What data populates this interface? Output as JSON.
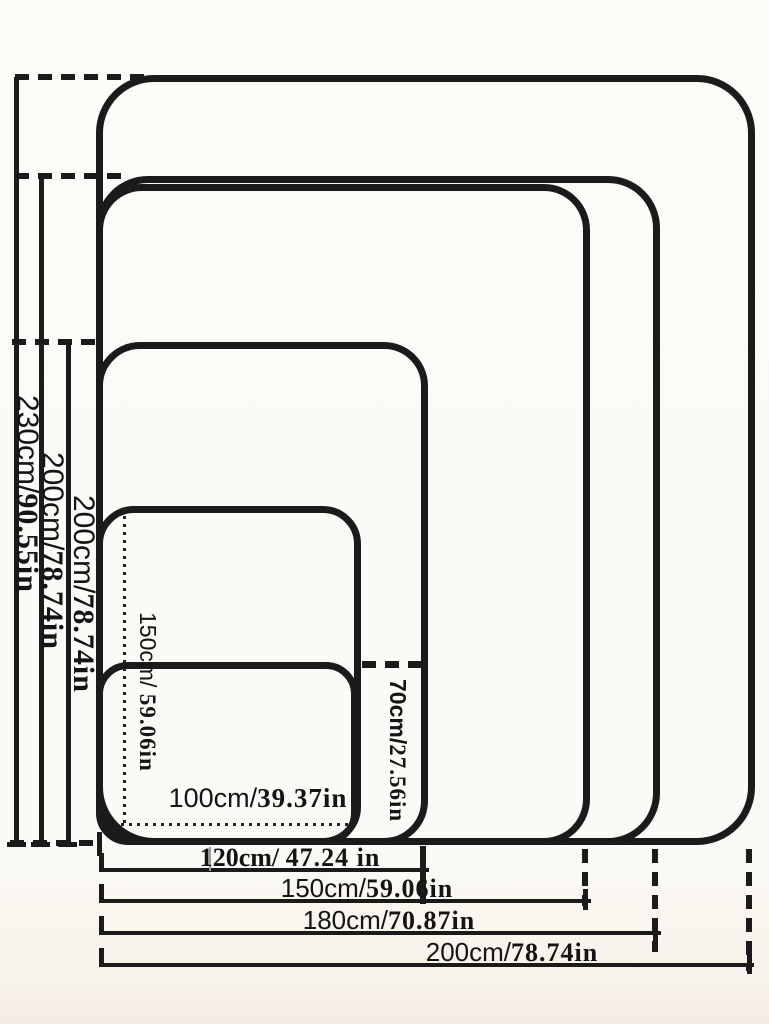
{
  "diagram": {
    "type": "nested-size-chart",
    "description_visible_sizes": [
      "200cm x 230cm",
      "180cm x 200cm",
      "150cm x 200cm",
      "120cm x 200cm (as printed)",
      "100cm x 150cm",
      "100cm x 70cm"
    ]
  },
  "labels": {
    "heights": [
      {
        "cm": "230cm/",
        "in": "90.55in"
      },
      {
        "cm": "200cm/",
        "in": "78.74in"
      },
      {
        "cm": "200cm/",
        "in": "78.74in"
      },
      {
        "cm": "150cm/ ",
        "in": "59.06in"
      },
      {
        "cm": "70cm/",
        "in": "27.56in"
      }
    ],
    "widths": [
      {
        "cm": "100cm/",
        "in": "39.37in"
      },
      {
        "cm": "120cm/ ",
        "in": "47.24 in"
      },
      {
        "cm": "150cm/",
        "in": "59.06in"
      },
      {
        "cm": "180cm/",
        "in": "70.87in"
      },
      {
        "cm": "200cm/",
        "in": "78.74in"
      }
    ]
  },
  "colors": {
    "line": "#1b1b1b",
    "text": "#141414",
    "background": "#fbfaf6"
  }
}
